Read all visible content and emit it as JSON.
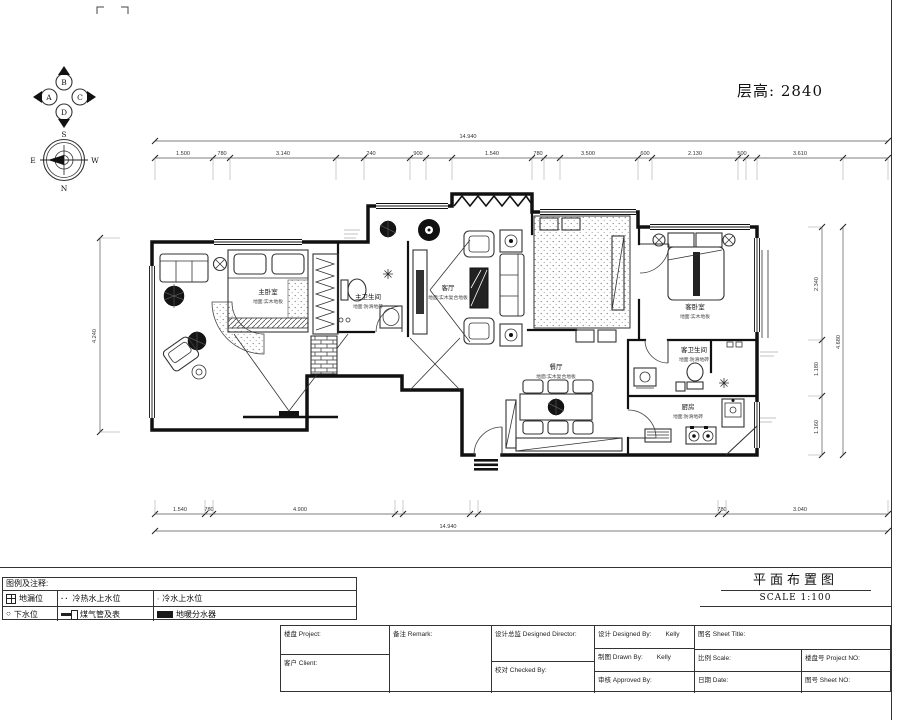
{
  "meta": {
    "floor_height": "层高: 2840",
    "drawing_title": "平面布置图",
    "scale": "SCALE 1:100"
  },
  "compass": {
    "n": "N",
    "s": "S",
    "e": "E",
    "w": "W",
    "axis_a": "A",
    "axis_b": "B",
    "axis_c": "C",
    "axis_d": "D"
  },
  "rooms": {
    "master_bedroom": {
      "name": "主卧室",
      "finish": "地面:实木地板"
    },
    "master_bath": {
      "name": "主卫生间",
      "finish": "地面:防滑地砖"
    },
    "living": {
      "name": "客厅",
      "finish": "地面:实木复合地板"
    },
    "dining": {
      "name": "餐厅",
      "finish": "地面:实木复合地板"
    },
    "guest_bedroom": {
      "name": "客卧室",
      "finish": "地面:实木地板"
    },
    "guest_bath": {
      "name": "客卫生间",
      "finish": "地面:防滑地砖"
    },
    "kitchen": {
      "name": "厨房",
      "finish": "地面:防滑地砖"
    }
  },
  "dims": {
    "top_overall": "14.940",
    "top": [
      "1.500",
      "780",
      "3.140",
      "240",
      "900",
      "1.540",
      "780",
      "3.500",
      "600",
      "2.130",
      "500",
      "3.610"
    ],
    "bottom": [
      "1.540",
      "780",
      "4.900",
      "780",
      "3.040"
    ],
    "bottom_overall": "14.940",
    "left": "4.240",
    "right": [
      "2.340",
      "1.180",
      "1.160"
    ],
    "right_overall": "4.680"
  },
  "legend": {
    "title": "图例及注释:",
    "items": [
      {
        "icon": "floor-drain",
        "label": "地漏位"
      },
      {
        "icon": "hot-cold-water",
        "label": "冷热水上水位"
      },
      {
        "icon": "cold-water",
        "label": "冷水上水位"
      },
      {
        "icon": "drain",
        "label": "下水位"
      },
      {
        "icon": "gas-pipe-meter",
        "label": "煤气管及表"
      },
      {
        "icon": "floor-heating-manifold",
        "label": "地暖分水器"
      }
    ]
  },
  "titleblock": {
    "project": "楼盘 Project:",
    "client": "客户 Client:",
    "remark": "备注 Remark:",
    "designed_director": "设计总监 Designed Director:",
    "checked_by": "校对 Checked By:",
    "designed_by": "设计 Designed By:",
    "designed_by_value": "Kelly",
    "drawn_by": "制图 Drawn By:",
    "drawn_by_value": "Kelly",
    "approved_by": "审核 Approved By:",
    "sheet_title": "图名 Sheet Title:",
    "scale": "比例 Scale:",
    "project_no": "楼盘号 Project NO:",
    "date": "日期 Date:",
    "sheet_no": "图号 Sheet NO:"
  }
}
